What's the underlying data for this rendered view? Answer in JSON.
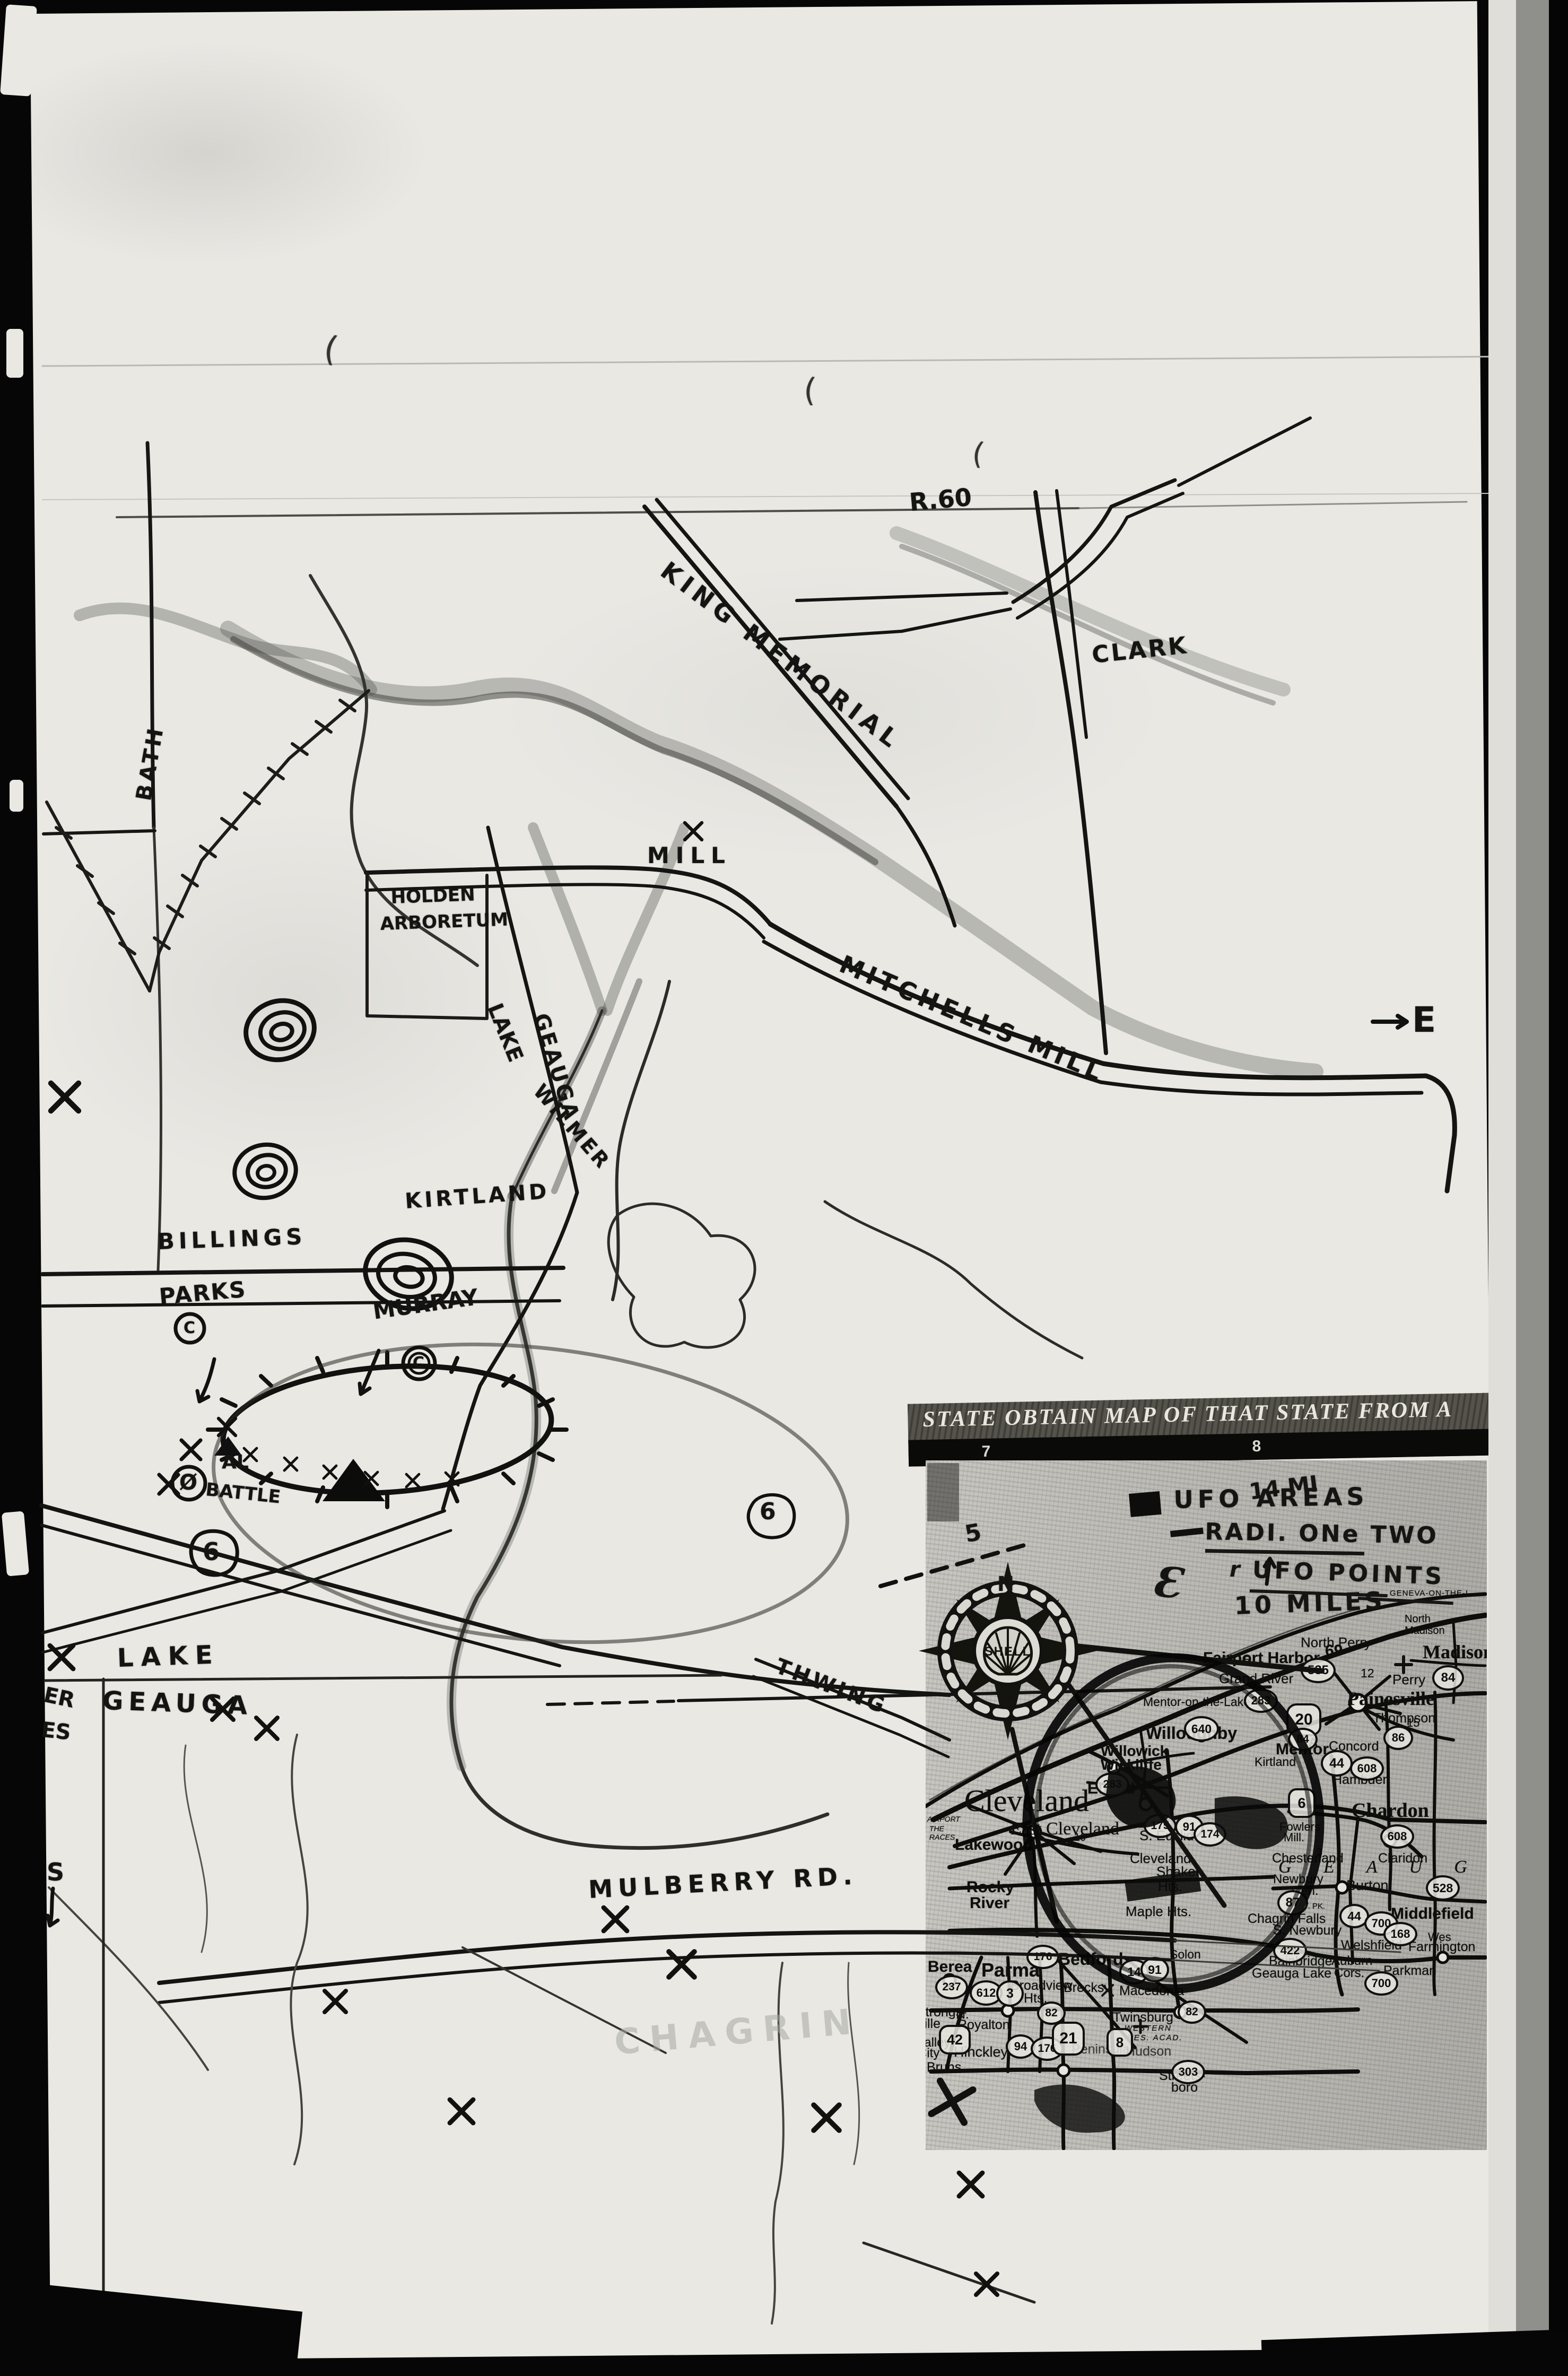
{
  "hand_map": {
    "labels": {
      "route_top": "R.60",
      "king_memorial": "KING MEMORIAL",
      "clark": "CLARK",
      "bath": "BATH",
      "holden_line1": "HOLDEN",
      "holden_line2": "ARBORETUM",
      "mill": "MILL",
      "mitchells_mill": "MITCHELLS MILL",
      "lake_river": "LAKE",
      "geauga_river": "GEAUGA",
      "wilmer": "WILMER",
      "kirtland": "KIRTLAND",
      "billings": "BILLINGS",
      "parks": "PARKS",
      "parks_c": "C",
      "murray": "MURRAY",
      "murray_c": "C",
      "al": "AL",
      "battle": "BATTLE",
      "battle_symbol": "Ø",
      "route6_a": "6",
      "route6_b": "6",
      "lake_left": "LAKE",
      "geauga_left": "GEAUGA",
      "margin_er": "ER",
      "margin_es": "ES",
      "margin_s": "S",
      "thwing": "THWING",
      "mulberry": "MULBERRY RD.",
      "east_e": "E",
      "faint_chagrin": "CHAGRIN"
    },
    "marks": {
      "m1": "(",
      "m2": "(",
      "m3": "("
    }
  },
  "inset": {
    "header": {
      "title": "STATE OBTAIN MAP OF THAT STATE FROM A",
      "grid_left": "7",
      "grid_right": "8"
    },
    "annotations": {
      "fourteen_mi": "14 MI",
      "five": "5",
      "ufo_areas": "UFO AREAS",
      "radii": "RADI. ONe TWO",
      "epsilon": "Ɛ",
      "r_mark": "r",
      "ufo_points": "UFO POINTS",
      "ten_miles": "10 MILES",
      "north": "N"
    },
    "compass": {
      "brand": "SHELL"
    },
    "cities": {
      "fairport": "Fairport Harbor",
      "grand_river": "Grand River",
      "north_perry": "North Perry",
      "north_madison_1": "North",
      "north_madison_2": "Madison",
      "madison": "Madison",
      "perry": "Perry",
      "painesville": "Painesville",
      "thompson": "Thompson",
      "concord": "Concord",
      "hambden": "Hambden",
      "mentor": "Mentor",
      "grid_a": "A",
      "mentor_on_the_lake": "Mentor-on-the-Lake",
      "willoughby": "Willoughby",
      "willowick": "Willowick",
      "wickliffe": "Wickliffe",
      "euclid": "Euclid",
      "kirtland": "Kirtland",
      "cleveland": "Cleveland",
      "east_cleveland": "East Cleveland",
      "lakewood": "Lakewood",
      "rocky": "Rocky",
      "river": "River",
      "s_euclid": "S. Euclid",
      "cleveland_hts": "Cleveland",
      "shaker": "Shaker",
      "hts": "Hts.",
      "maple_hts": "Maple Hts.",
      "bedford": "Bedford",
      "berea": "Berea",
      "parma": "Parma",
      "broadview": "Broadview",
      "broadview_hts": "Hts.",
      "brecksville": "Brecksv.",
      "macedonia": "Macedonia",
      "solon": "Solon",
      "twinsburg": "Twinsburg",
      "western_res_1": "WESTERN",
      "western_res_2": "RES. ACAD.",
      "n_royalton_1": "N.",
      "n_royalton_2": "Royalton",
      "strongsville_1": "Strongs-",
      "strongsville_2": "ville",
      "valley_1": "Valley",
      "valley_2": "City",
      "hinckley": "Hinckley",
      "peninsula": "Peninsula",
      "hudson": "Hudson",
      "streetsboro_1": "Streets-",
      "streetsboro_2": "boro",
      "geauga_county": "G E A U G A",
      "chesterland": "Chesterland",
      "claridon": "Claridon",
      "fowlers_1": "Fowlers",
      "fowlers_2": "Mill.",
      "chardon": "Chardon",
      "newbury_1": "Newbury",
      "newbury_2": "Cen.",
      "burton": "Burton",
      "st_pk": "ST. PK.",
      "middlefield": "Middlefield",
      "chagrin_falls": "Chagrin Falls",
      "s_newbury": "S. Newbury",
      "welshfield": "Welshfield",
      "farmington": "Farmington",
      "bainbridge": "Bainbridge",
      "geauga_lake": "Geauga Lake",
      "auburn_1": "Auburn",
      "auburn_2": "Cors.",
      "parkman": "Parkman"
    },
    "shields": {
      "s535": "535",
      "s84a": "84",
      "s20": "20",
      "s283a": "283",
      "s640": "640",
      "s84b": "84",
      "s44a": "44",
      "s608a": "608",
      "s86": "86",
      "s528": "528",
      "s6": "6",
      "s91a": "91",
      "s175": "175",
      "s174": "174",
      "s283b": "283",
      "s608b": "608",
      "s87": "87",
      "s44b": "44",
      "s700a": "700",
      "s168": "168",
      "s422": "422",
      "s700b": "700",
      "s176a": "176",
      "s237": "237",
      "s612": "612",
      "s3": "3",
      "s82a": "82",
      "s82b": "82",
      "s14": "14",
      "s91b": "91",
      "s42": "42",
      "s94": "94",
      "s176b": "176",
      "s21": "21",
      "s8": "8",
      "s303": "303"
    },
    "numbers": {
      "n69": "69",
      "n12": "12",
      "n15": "15",
      "n10": "10",
      "n5": "5",
      "n3": "3"
    },
    "fragments": {
      "geneva": "GENEVA-ON-THE-L",
      "airport1": "AIRPORT",
      "airport2": "THE",
      "airport3": "RACES",
      "wes": "Wes",
      "bruns": "Bruns"
    }
  }
}
